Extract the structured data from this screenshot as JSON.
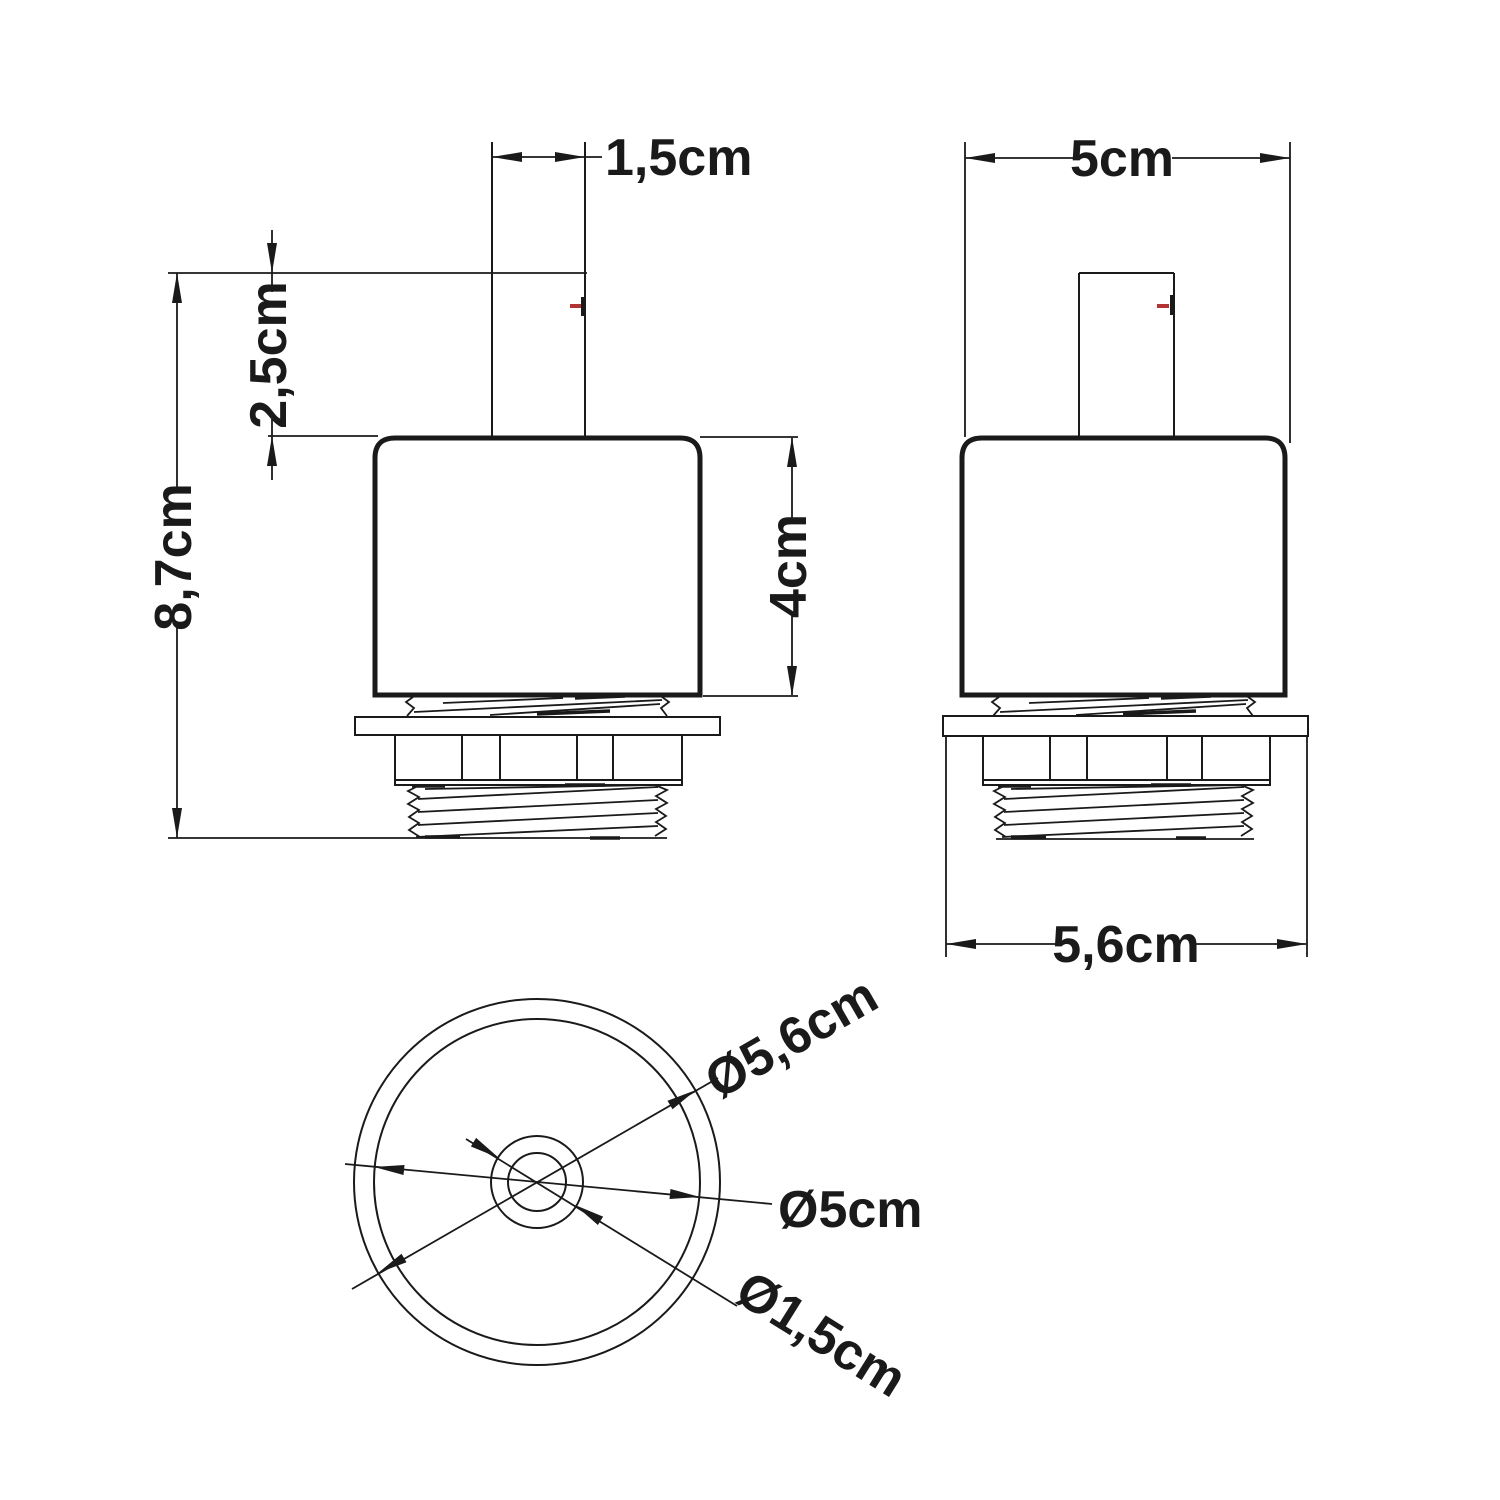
{
  "drawing": {
    "type": "technical-dimension-drawing",
    "views": [
      "front",
      "side",
      "bottom"
    ],
    "labels": {
      "front": {
        "stem_width": "1,5cm",
        "stem_height": "2,5cm",
        "total_height": "8,7cm",
        "body_height": "4cm"
      },
      "side": {
        "body_width": "5cm",
        "flange_width": "5,6cm"
      },
      "bottom": {
        "flange_diameter": "Ø5,6cm",
        "body_diameter": "Ø5cm",
        "stem_diameter": "Ø1,5cm"
      }
    },
    "colors": {
      "line": "#1a1a1a",
      "accent_red": "#b23333",
      "background": "#ffffff"
    }
  }
}
